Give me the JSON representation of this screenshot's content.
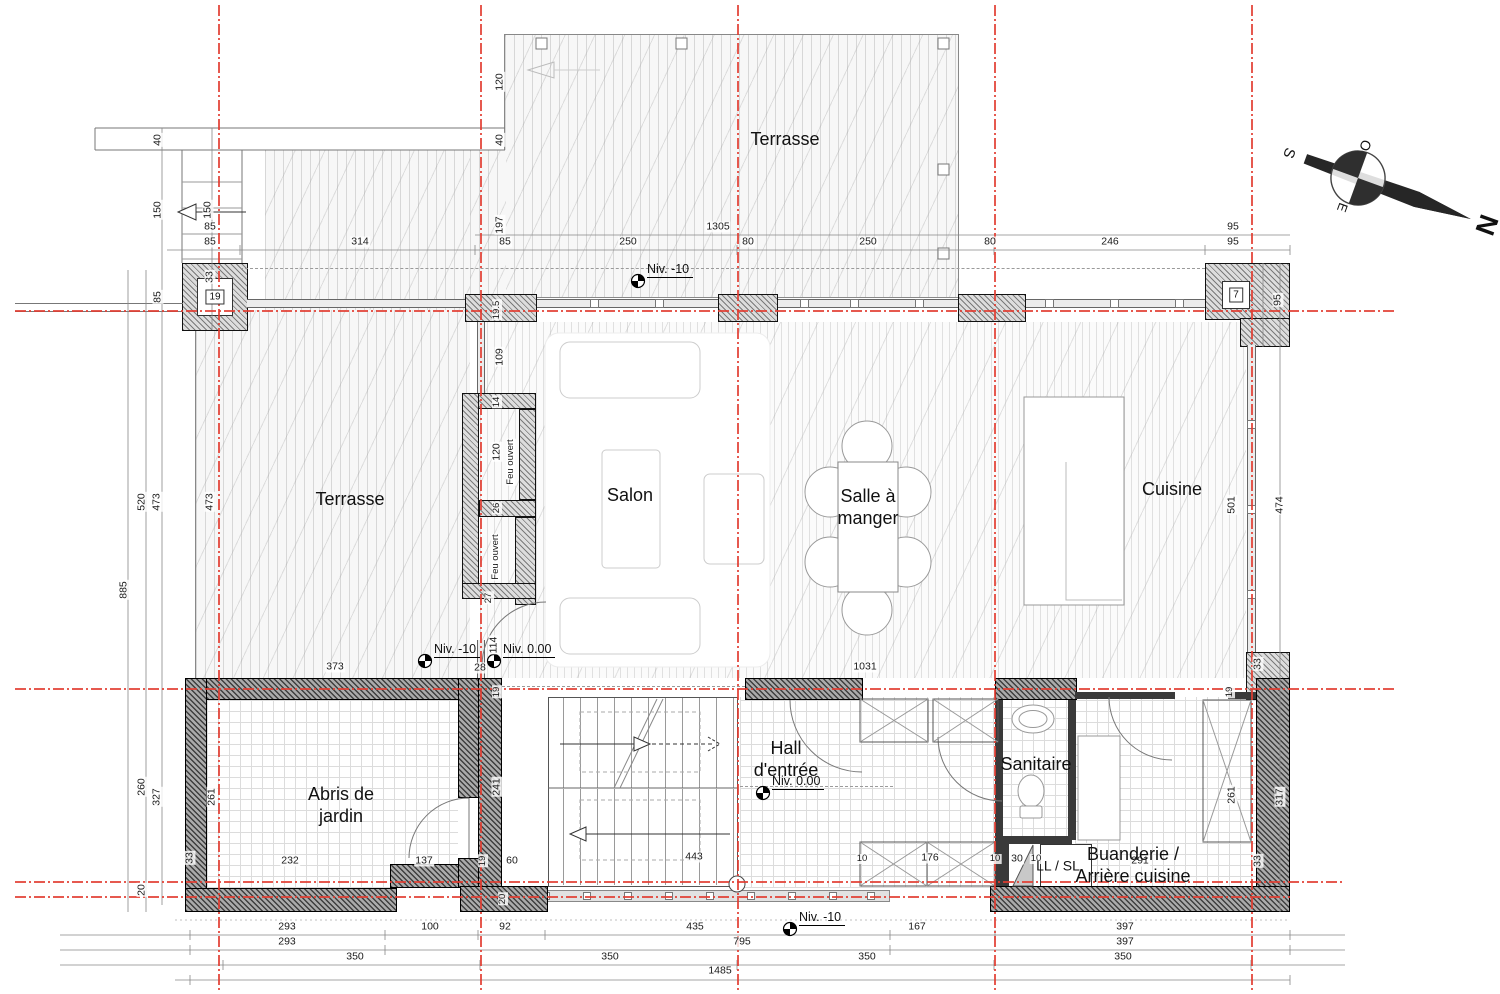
{
  "title": "Plan rez-de-chaussée",
  "rooms": [
    {
      "lines": [
        "Terrasse"
      ],
      "x": 785,
      "y": 140
    },
    {
      "lines": [
        "Terrasse"
      ],
      "x": 350,
      "y": 500
    },
    {
      "lines": [
        "Salon"
      ],
      "x": 630,
      "y": 496
    },
    {
      "lines": [
        "Salle à",
        "manger"
      ],
      "x": 868,
      "y": 508
    },
    {
      "lines": [
        "Cuisine"
      ],
      "x": 1172,
      "y": 490
    },
    {
      "lines": [
        "Hall",
        "d'entrée"
      ],
      "x": 786,
      "y": 760
    },
    {
      "lines": [
        "Sanitaire"
      ],
      "x": 1036,
      "y": 765
    },
    {
      "lines": [
        "Abris de",
        "jardin"
      ],
      "x": 341,
      "y": 806
    },
    {
      "lines": [
        "Buanderie /",
        "Arrière cuisine"
      ],
      "x": 1133,
      "y": 866
    },
    {
      "lines": [
        "LL / SL"
      ],
      "x": 1058,
      "y": 866,
      "sm": true
    }
  ],
  "levels": [
    {
      "t": "Niv. -10",
      "x": 638,
      "y": 281
    },
    {
      "t": "Niv. -10",
      "x": 425,
      "y": 661
    },
    {
      "t": "Niv. 0.00",
      "x": 494,
      "y": 661
    },
    {
      "t": "Niv. 0.00",
      "x": 763,
      "y": 793
    },
    {
      "t": "Niv. -10",
      "x": 790,
      "y": 929
    }
  ],
  "boxes": [
    {
      "t": "19",
      "x": 215,
      "y": 297
    },
    {
      "t": "7",
      "x": 1236,
      "y": 295
    }
  ],
  "compass": {
    "n": "N",
    "s": "S",
    "e": "E",
    "o": "O"
  },
  "dimensions": [
    {
      "t": "85",
      "x": 210,
      "y": 227
    },
    {
      "t": "85",
      "x": 210,
      "y": 242
    },
    {
      "t": "314",
      "x": 360,
      "y": 242
    },
    {
      "t": "85",
      "x": 505,
      "y": 242
    },
    {
      "t": "250",
      "x": 628,
      "y": 242
    },
    {
      "t": "1305",
      "x": 718,
      "y": 227
    },
    {
      "t": "80",
      "x": 748,
      "y": 242
    },
    {
      "t": "250",
      "x": 868,
      "y": 242
    },
    {
      "t": "80",
      "x": 990,
      "y": 242
    },
    {
      "t": "246",
      "x": 1110,
      "y": 242
    },
    {
      "t": "95",
      "x": 1233,
      "y": 227
    },
    {
      "t": "95",
      "x": 1233,
      "y": 242
    },
    {
      "t": "40",
      "x": 158,
      "y": 140,
      "r": -90
    },
    {
      "t": "40",
      "x": 500,
      "y": 140,
      "r": -90
    },
    {
      "t": "120",
      "x": 500,
      "y": 82,
      "r": -90
    },
    {
      "t": "150",
      "x": 158,
      "y": 210,
      "r": -90
    },
    {
      "t": "150",
      "x": 208,
      "y": 210,
      "r": -90
    },
    {
      "t": "197",
      "x": 500,
      "y": 225,
      "r": -90
    },
    {
      "t": "85",
      "x": 158,
      "y": 297,
      "r": -90
    },
    {
      "t": "33",
      "x": 210,
      "y": 277,
      "r": -90
    },
    {
      "t": "885",
      "x": 124,
      "y": 590,
      "r": -90
    },
    {
      "t": "520",
      "x": 142,
      "y": 502,
      "r": -90
    },
    {
      "t": "473",
      "x": 157,
      "y": 502,
      "r": -90
    },
    {
      "t": "473",
      "x": 210,
      "y": 502,
      "r": -90
    },
    {
      "t": "260",
      "x": 142,
      "y": 787,
      "r": -90
    },
    {
      "t": "327",
      "x": 157,
      "y": 797,
      "r": -90
    },
    {
      "t": "261",
      "x": 212,
      "y": 797,
      "r": -90
    },
    {
      "t": "20",
      "x": 142,
      "y": 890,
      "r": -90
    },
    {
      "t": "33",
      "x": 190,
      "y": 858,
      "r": -90
    },
    {
      "t": "19.5",
      "x": 497,
      "y": 310,
      "r": -90,
      "s": true
    },
    {
      "t": "109",
      "x": 500,
      "y": 357,
      "r": -90
    },
    {
      "t": "14",
      "x": 497,
      "y": 402,
      "r": -90,
      "s": true
    },
    {
      "t": "120",
      "x": 497,
      "y": 452,
      "r": -90
    },
    {
      "t": "Feu ouvert",
      "x": 511,
      "y": 462,
      "r": -90,
      "s": true
    },
    {
      "t": "26",
      "x": 497,
      "y": 508,
      "r": -90,
      "s": true
    },
    {
      "t": "Feu ouvert",
      "x": 496,
      "y": 557,
      "r": -90,
      "s": true
    },
    {
      "t": "27",
      "x": 489,
      "y": 598,
      "r": -90,
      "s": true
    },
    {
      "t": "114",
      "x": 494,
      "y": 645,
      "r": -90
    },
    {
      "t": "28",
      "x": 480,
      "y": 668
    },
    {
      "t": "19",
      "x": 497,
      "y": 692,
      "r": -90,
      "s": true
    },
    {
      "t": "373",
      "x": 335,
      "y": 667
    },
    {
      "t": "1031",
      "x": 865,
      "y": 667
    },
    {
      "t": "241",
      "x": 497,
      "y": 787,
      "r": -90
    },
    {
      "t": "19",
      "x": 483,
      "y": 861,
      "r": -90,
      "s": true
    },
    {
      "t": "20",
      "x": 503,
      "y": 899,
      "r": -90,
      "s": true
    },
    {
      "t": "232",
      "x": 290,
      "y": 861
    },
    {
      "t": "137",
      "x": 424,
      "y": 861
    },
    {
      "t": "60",
      "x": 512,
      "y": 861
    },
    {
      "t": "443",
      "x": 694,
      "y": 857
    },
    {
      "t": "10",
      "x": 862,
      "y": 859,
      "s": true
    },
    {
      "t": "176",
      "x": 930,
      "y": 858
    },
    {
      "t": "10",
      "x": 995,
      "y": 859,
      "s": true
    },
    {
      "t": "30",
      "x": 1017,
      "y": 859
    },
    {
      "t": "10",
      "x": 1036,
      "y": 859,
      "s": true
    },
    {
      "t": "291",
      "x": 1140,
      "y": 861
    },
    {
      "t": "33",
      "x": 1258,
      "y": 861,
      "r": -90
    },
    {
      "t": "95",
      "x": 1278,
      "y": 300,
      "r": -90
    },
    {
      "t": "501",
      "x": 1232,
      "y": 505,
      "r": -90
    },
    {
      "t": "474",
      "x": 1280,
      "y": 505,
      "r": -90
    },
    {
      "t": "33",
      "x": 1258,
      "y": 664,
      "r": -90
    },
    {
      "t": "19",
      "x": 1230,
      "y": 692,
      "r": -90,
      "s": true
    },
    {
      "t": "261",
      "x": 1232,
      "y": 795,
      "r": -90
    },
    {
      "t": "317",
      "x": 1280,
      "y": 797,
      "r": -90
    },
    {
      "t": "293",
      "x": 287,
      "y": 927
    },
    {
      "t": "100",
      "x": 430,
      "y": 927
    },
    {
      "t": "92",
      "x": 505,
      "y": 927
    },
    {
      "t": "435",
      "x": 695,
      "y": 927
    },
    {
      "t": "167",
      "x": 917,
      "y": 927
    },
    {
      "t": "397",
      "x": 1125,
      "y": 927
    },
    {
      "t": "293",
      "x": 287,
      "y": 942
    },
    {
      "t": "795",
      "x": 742,
      "y": 942
    },
    {
      "t": "397",
      "x": 1125,
      "y": 942
    },
    {
      "t": "350",
      "x": 355,
      "y": 957
    },
    {
      "t": "350",
      "x": 610,
      "y": 957
    },
    {
      "t": "350",
      "x": 867,
      "y": 957
    },
    {
      "t": "350",
      "x": 1123,
      "y": 957
    },
    {
      "t": "1485",
      "x": 720,
      "y": 971
    }
  ]
}
